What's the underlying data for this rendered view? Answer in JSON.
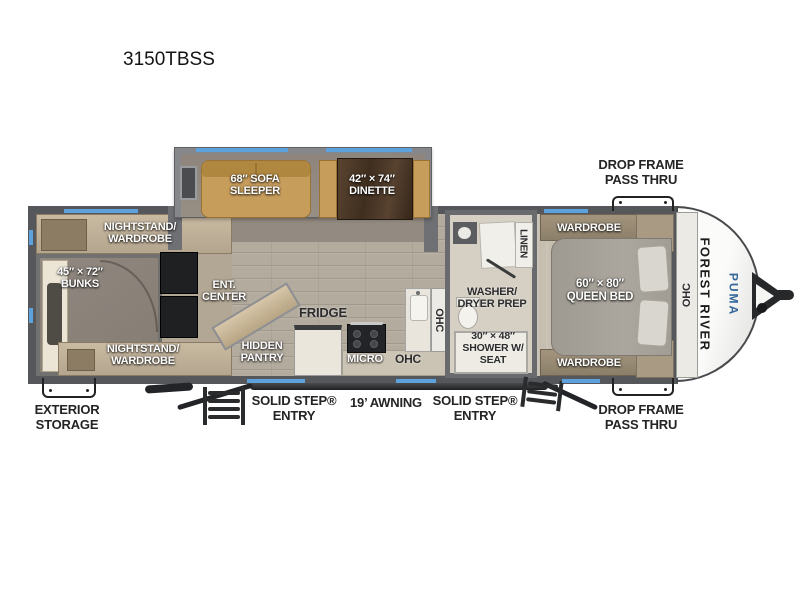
{
  "title": "3150TBSS",
  "branding": {
    "manufacturer": "FOREST RIVER",
    "model": "PUMA"
  },
  "colors": {
    "window_blue": "#5DA2DD",
    "puma_blue": "#33669A",
    "wall_gray": "#56575B",
    "sofa_tan": "#C79D5C",
    "floor_wood": "#B3AB9E",
    "carpet_gray": "#8C847A",
    "bed_gray": "#A7A39A",
    "cap_white": "#F5F5F4"
  },
  "exterior": {
    "pass_thru_top": "DROP FRAME\nPASS THRU",
    "pass_thru_bottom": "DROP FRAME\nPASS THRU",
    "exterior_storage": "EXTERIOR\nSTORAGE",
    "entry_left": "SOLID STEP®\nENTRY",
    "awning": "19’ AWNING",
    "entry_right": "SOLID STEP®\nENTRY"
  },
  "interior": {
    "sofa": "68″ SOFA\nSLEEPER",
    "dinette": "42″ × 74″\nDINETTE",
    "nightstand_top": "NIGHTSTAND/\nWARDROBE",
    "bunks": "45″ × 72″\nBUNKS",
    "nightstand_bottom": "NIGHTSTAND/\nWARDROBE",
    "ent_center": "ENT.\nCENTER",
    "hidden_pantry": "HIDDEN\nPANTRY",
    "fridge": "FRIDGE",
    "micro": "MICRO",
    "ohc_kitchen": "OHC",
    "ohc_kitchen_upper": "OHC",
    "washer_dryer": "WASHER/\nDRYER PREP",
    "linen": "LINEN",
    "shower": "30″ × 48″\nSHOWER W/\nSEAT",
    "wardrobe_top": "WARDROBE",
    "wardrobe_bottom": "WARDROBE",
    "queen_bed": "60″ × 80″\nQUEEN BED",
    "ohc_bedroom": "OHC"
  }
}
